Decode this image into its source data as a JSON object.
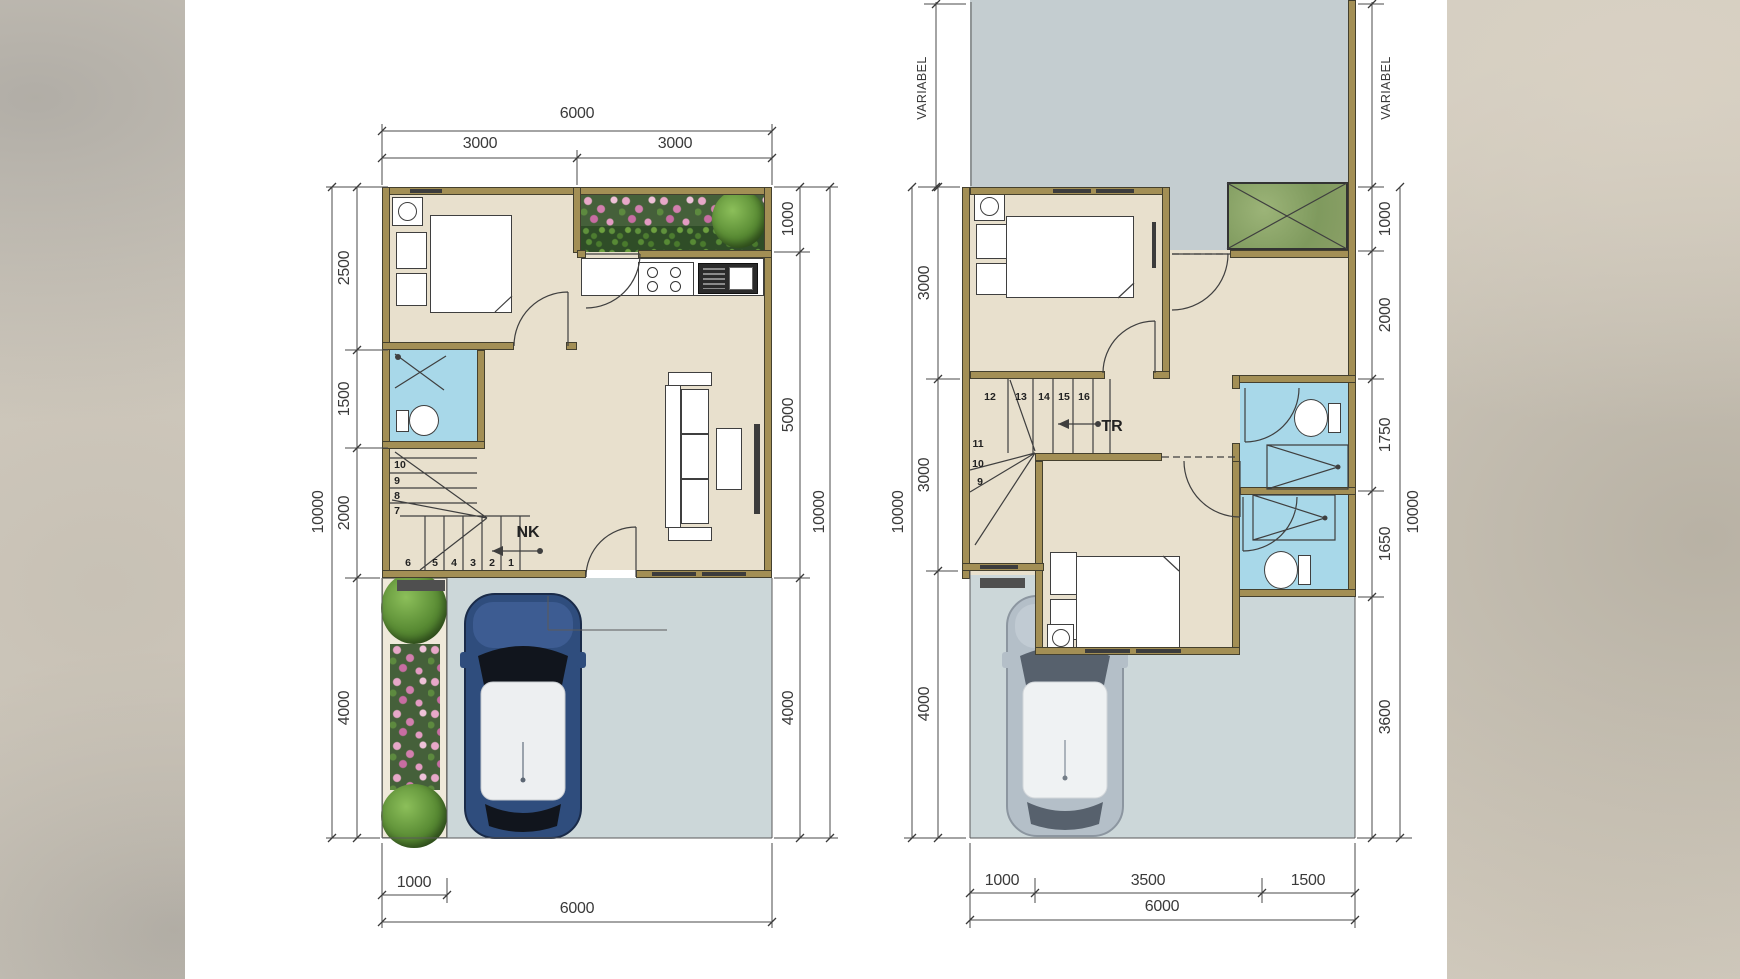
{
  "palette": {
    "wall": "#a38f55",
    "floor": "#e8e0cd",
    "bathroom_floor": "#a8d8e9",
    "paving": "#ccd7d9",
    "yard": "#c4cdd0",
    "planter_green": "#45603a",
    "flower_pink": "#d27fae",
    "car_blue": "#2f4d7d",
    "car_gray": "#b3bdc7",
    "canvas": "#ffffff"
  },
  "left_plan": {
    "name": "ground-floor-plan",
    "dims": {
      "top_total": "6000",
      "top_seg_a": "3000",
      "top_seg_b": "3000",
      "left_total": "10000",
      "left_seg_a": "2500",
      "left_seg_b": "1500",
      "left_seg_c": "2000",
      "left_seg_d": "4000",
      "right_seg_a": "1000",
      "right_seg_b": "5000",
      "right_seg_c": "4000",
      "right_total": "10000",
      "bottom_seg_a": "1000",
      "bottom_total": "6000"
    },
    "stairs": {
      "label": "NK",
      "steps_upper": [
        "10",
        "9",
        "8",
        "7"
      ],
      "steps_lower": [
        "6",
        "5",
        "4",
        "3",
        "2",
        "1"
      ]
    }
  },
  "right_plan": {
    "name": "upper-floor-plan",
    "dims": {
      "left_variable": "VARIABEL",
      "right_variable": "VARIABEL",
      "left_total": "10000",
      "left_seg_a": "3000",
      "left_seg_b": "3000",
      "left_seg_c": "4000",
      "right_seg_a": "1000",
      "right_seg_b": "2000",
      "right_seg_c": "1750",
      "right_seg_d": "1650",
      "right_seg_e": "3600",
      "right_total": "10000",
      "bottom_seg_a": "1000",
      "bottom_seg_b": "3500",
      "bottom_seg_c": "1500",
      "bottom_total": "6000"
    },
    "stairs": {
      "label": "TR",
      "steps_top": [
        "12",
        "13",
        "14",
        "15",
        "16"
      ],
      "steps_left": [
        "11",
        "10",
        "9"
      ]
    }
  }
}
